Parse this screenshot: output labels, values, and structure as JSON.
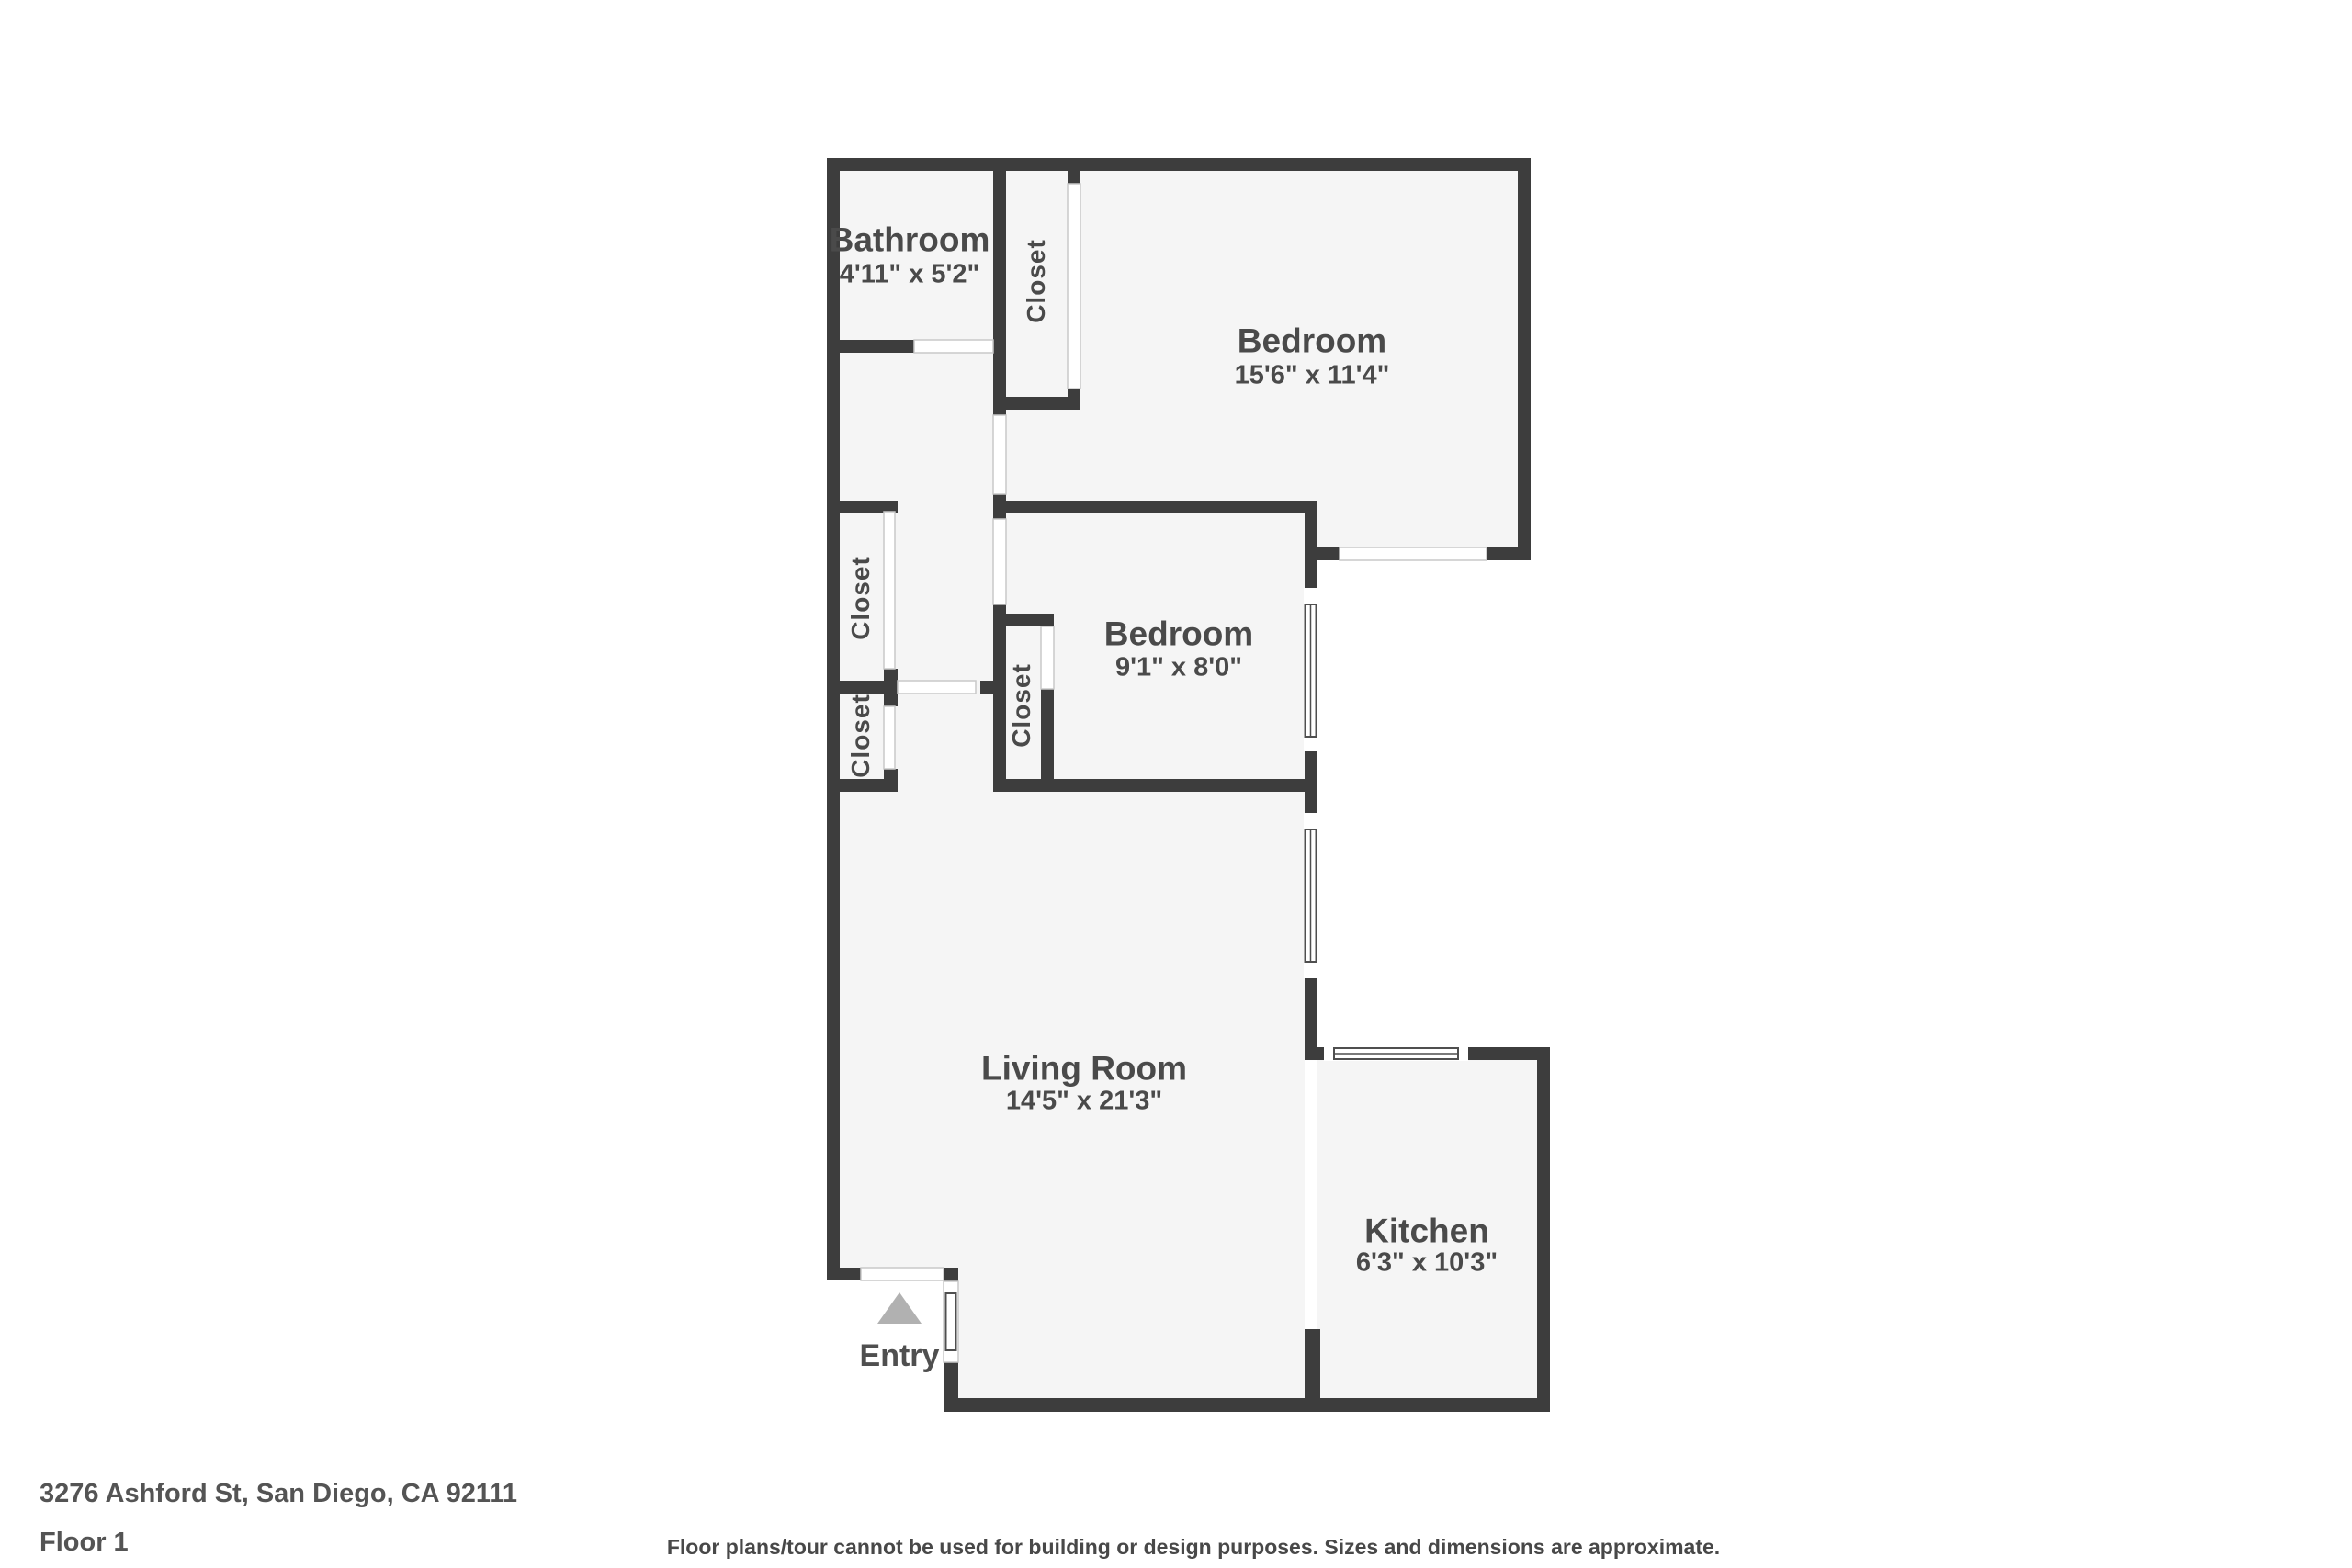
{
  "colors": {
    "wall": "#3d3d3d",
    "room_fill": "#f5f5f5",
    "background": "#ffffff",
    "label_text": "#4a4a4a",
    "entry_arrow": "#b1b1b1",
    "opening_outline": "#c9c9c9",
    "window_frame": "#4f4f4f"
  },
  "floor_plan": {
    "rooms": {
      "bathroom": {
        "name": "Bathroom",
        "dims": "4'11\" x 5'2\""
      },
      "bedroom_top": {
        "name": "Bedroom",
        "dims": "15'6\" x 11'4\""
      },
      "bedroom_middle": {
        "name": "Bedroom",
        "dims": "9'1\" x 8'0\""
      },
      "living_room": {
        "name": "Living Room",
        "dims": "14'5\" x 21'3\""
      },
      "kitchen": {
        "name": "Kitchen",
        "dims": "6'3\" x 10'3\""
      }
    },
    "closets": {
      "hall": "Closet",
      "hall_upper": "Closet",
      "hall_lower": "Closet",
      "bedroom": "Closet"
    },
    "entry": "Entry"
  },
  "footer": {
    "address": "3276 Ashford St, San Diego, CA 92111",
    "floor": "Floor 1",
    "disclaimer": "Floor plans/tour cannot be used for building or design purposes. Sizes and dimensions are approximate."
  }
}
